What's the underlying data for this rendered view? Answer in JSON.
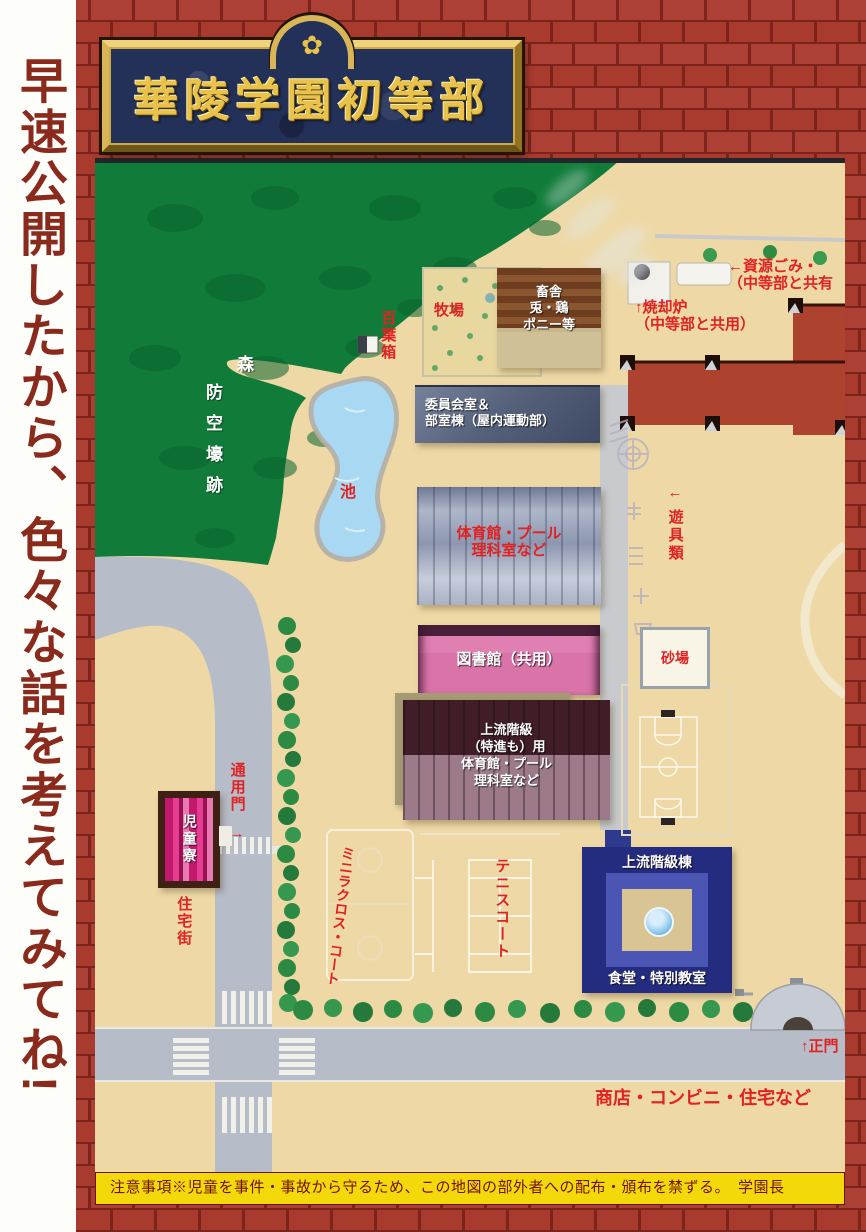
{
  "side_caption": "早速公開したから、色々な話を考えてみてね!",
  "sign": {
    "title": "華陵学園初等部",
    "crest_icon": "✿"
  },
  "notice": "注意事項※児童を事件・事故から守るため、この地図の部外者への配布・頒布を禁ずる。　学園長",
  "map": {
    "areas": {
      "forest": "森",
      "air_raid_shelter": "防空壕跡",
      "weather_box": "百葉箱",
      "pond": "池",
      "pasture": "牧場",
      "residential": "住宅街",
      "shops_note": "商店・コンビニ・住宅など"
    },
    "buildings": {
      "barn_lines": [
        "畜舎",
        "兎・鶏",
        "ポニー等"
      ],
      "committee_lines": [
        "委員会室＆",
        "部室棟（屋内運動部）"
      ],
      "gym_lines": [
        "体育館・プール",
        "理科室など"
      ],
      "library": "図書館（共用）",
      "upper_gym_lines": [
        "上流階級",
        "（特進も）用",
        "体育館・プール",
        "理科室など"
      ],
      "upper_class_hall": "上流階級棟",
      "upper_class_hall_sub": "食堂・特別教室",
      "dormitory": "児童寮",
      "sandbox": "砂場"
    },
    "labels": {
      "incinerator_lines": [
        "↑焼却炉",
        "（中等部と共用）"
      ],
      "recycling_lines": [
        "←資源ごみ・",
        "（中等部と共有"
      ],
      "playground_arrow": "←",
      "playground": "遊具類",
      "side_gate": "通用門",
      "side_gate_arrow": "→",
      "main_gate": "↑正門",
      "mini_lacrosse_court": "ミニラクロス・コート",
      "tennis_court": "テニスコート"
    },
    "colors": {
      "label_red": "#e02222",
      "forest_green": "#117c3a",
      "map_tan": "#eed9a6",
      "road_gray": "#b6bcc8",
      "brick_red": "#ad4034",
      "sign_navy": "#233058",
      "sign_gold": "#e9c24b"
    }
  }
}
